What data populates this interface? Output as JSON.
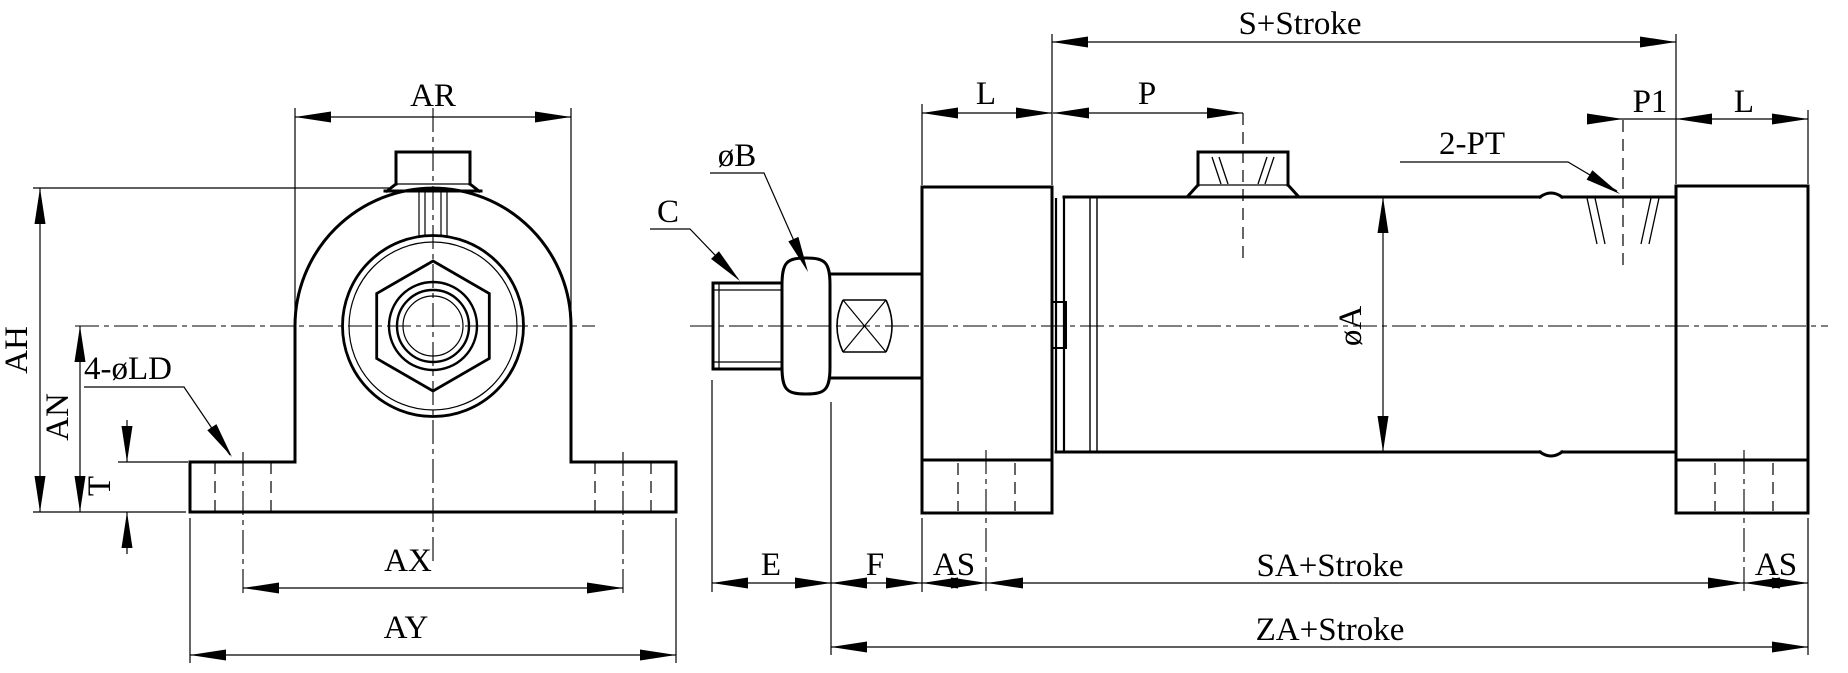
{
  "colors": {
    "background": "#ffffff",
    "line": "#000000"
  },
  "front_view": {
    "dim_ar": "AR",
    "dim_ah": "AH",
    "dim_an": "AN",
    "dim_t": "T",
    "callout_mount_holes": "4-øLD",
    "dim_ax": "AX",
    "dim_ay": "AY"
  },
  "side_view": {
    "callout_rod_thread": "C",
    "callout_rod_flat": "øB",
    "dim_l_front": "L",
    "dim_p": "P",
    "dim_s_stroke": "S+Stroke",
    "dim_p1": "P1",
    "dim_l_rear": "L",
    "callout_ports": "2-PT",
    "dim_bore": "øA",
    "dim_e": "E",
    "dim_f": "F",
    "dim_as_front": "AS",
    "dim_sa_stroke": "SA+Stroke",
    "dim_as_rear": "AS",
    "dim_za_stroke": "ZA+Stroke"
  }
}
